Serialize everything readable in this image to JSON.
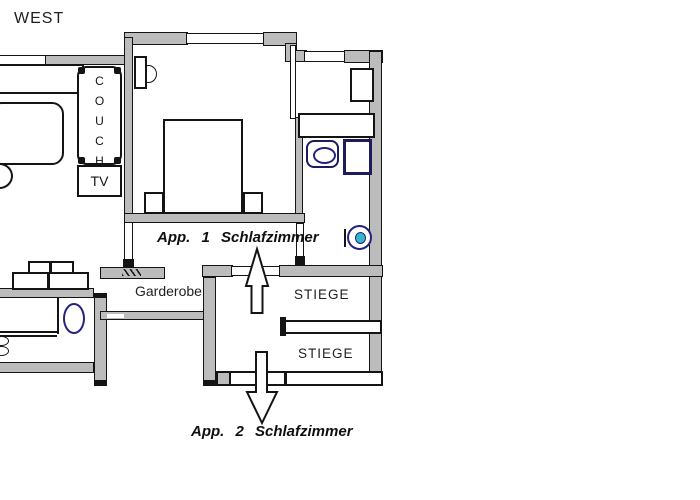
{
  "labels": {
    "west": "WEST",
    "couch": "COUCH",
    "tv": "TV",
    "app1": "App. 1 Schlafzimmer",
    "garderobe": "Garderobe",
    "stiege_upper": "STIEGE",
    "stiege_lower": "STIEGE",
    "app2": "App. 2 Schlafzimmer"
  },
  "colors": {
    "wall_fill": "#bcbcbc",
    "line_black": "#141414",
    "fixture_navy": "#23237e",
    "toilet_cyan": "#38b6c9",
    "text_color": "#1f1f1f",
    "canvas_bg": "#ffffff"
  }
}
